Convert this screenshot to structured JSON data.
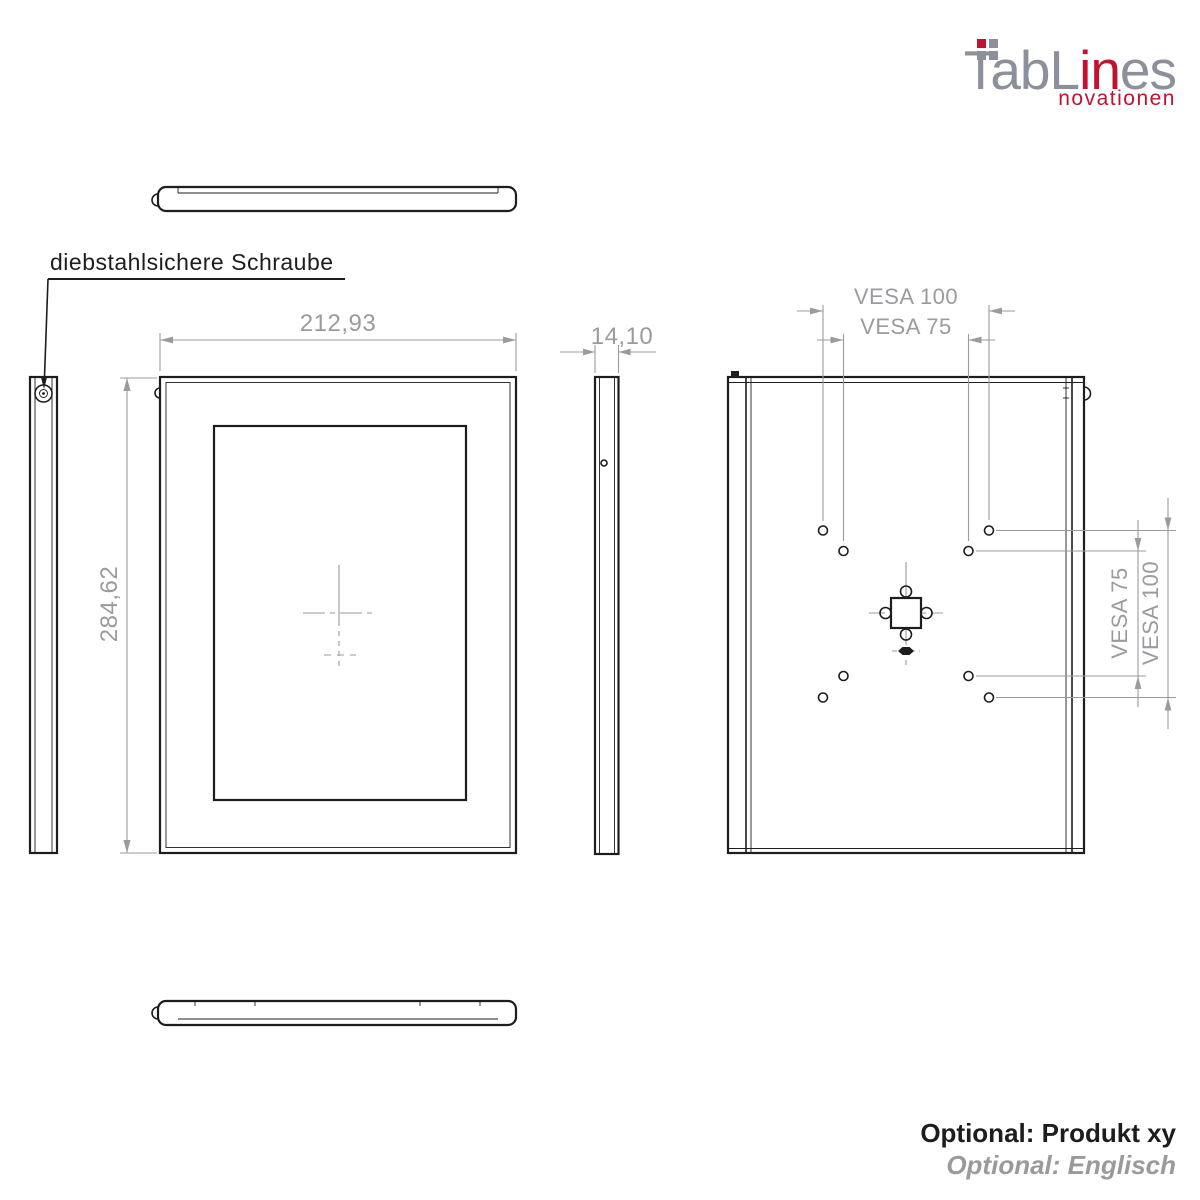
{
  "colors": {
    "brand_red": "#c3122f",
    "logo_gray": "#8b909a",
    "ink": "#1d1d1b",
    "dim_gray": "#9b9b9f",
    "footer_gray": "#9a9a9a",
    "background": "#ffffff"
  },
  "logo": {
    "part1": "TabL",
    "part2": "in",
    "part3": "es",
    "tagline": "novationen"
  },
  "callout": {
    "screw_label": "diebstahlsichere Schraube"
  },
  "dims": {
    "width": "212,93",
    "depth": "14,10",
    "height": "284,62",
    "vesa100_top": "VESA 100",
    "vesa75_top": "VESA 75",
    "vesa75_right": "VESA 75",
    "vesa100_right": "VESA 100"
  },
  "footer": {
    "option_product": "Optional: Produkt xy",
    "option_language": "Optional: Englisch"
  }
}
